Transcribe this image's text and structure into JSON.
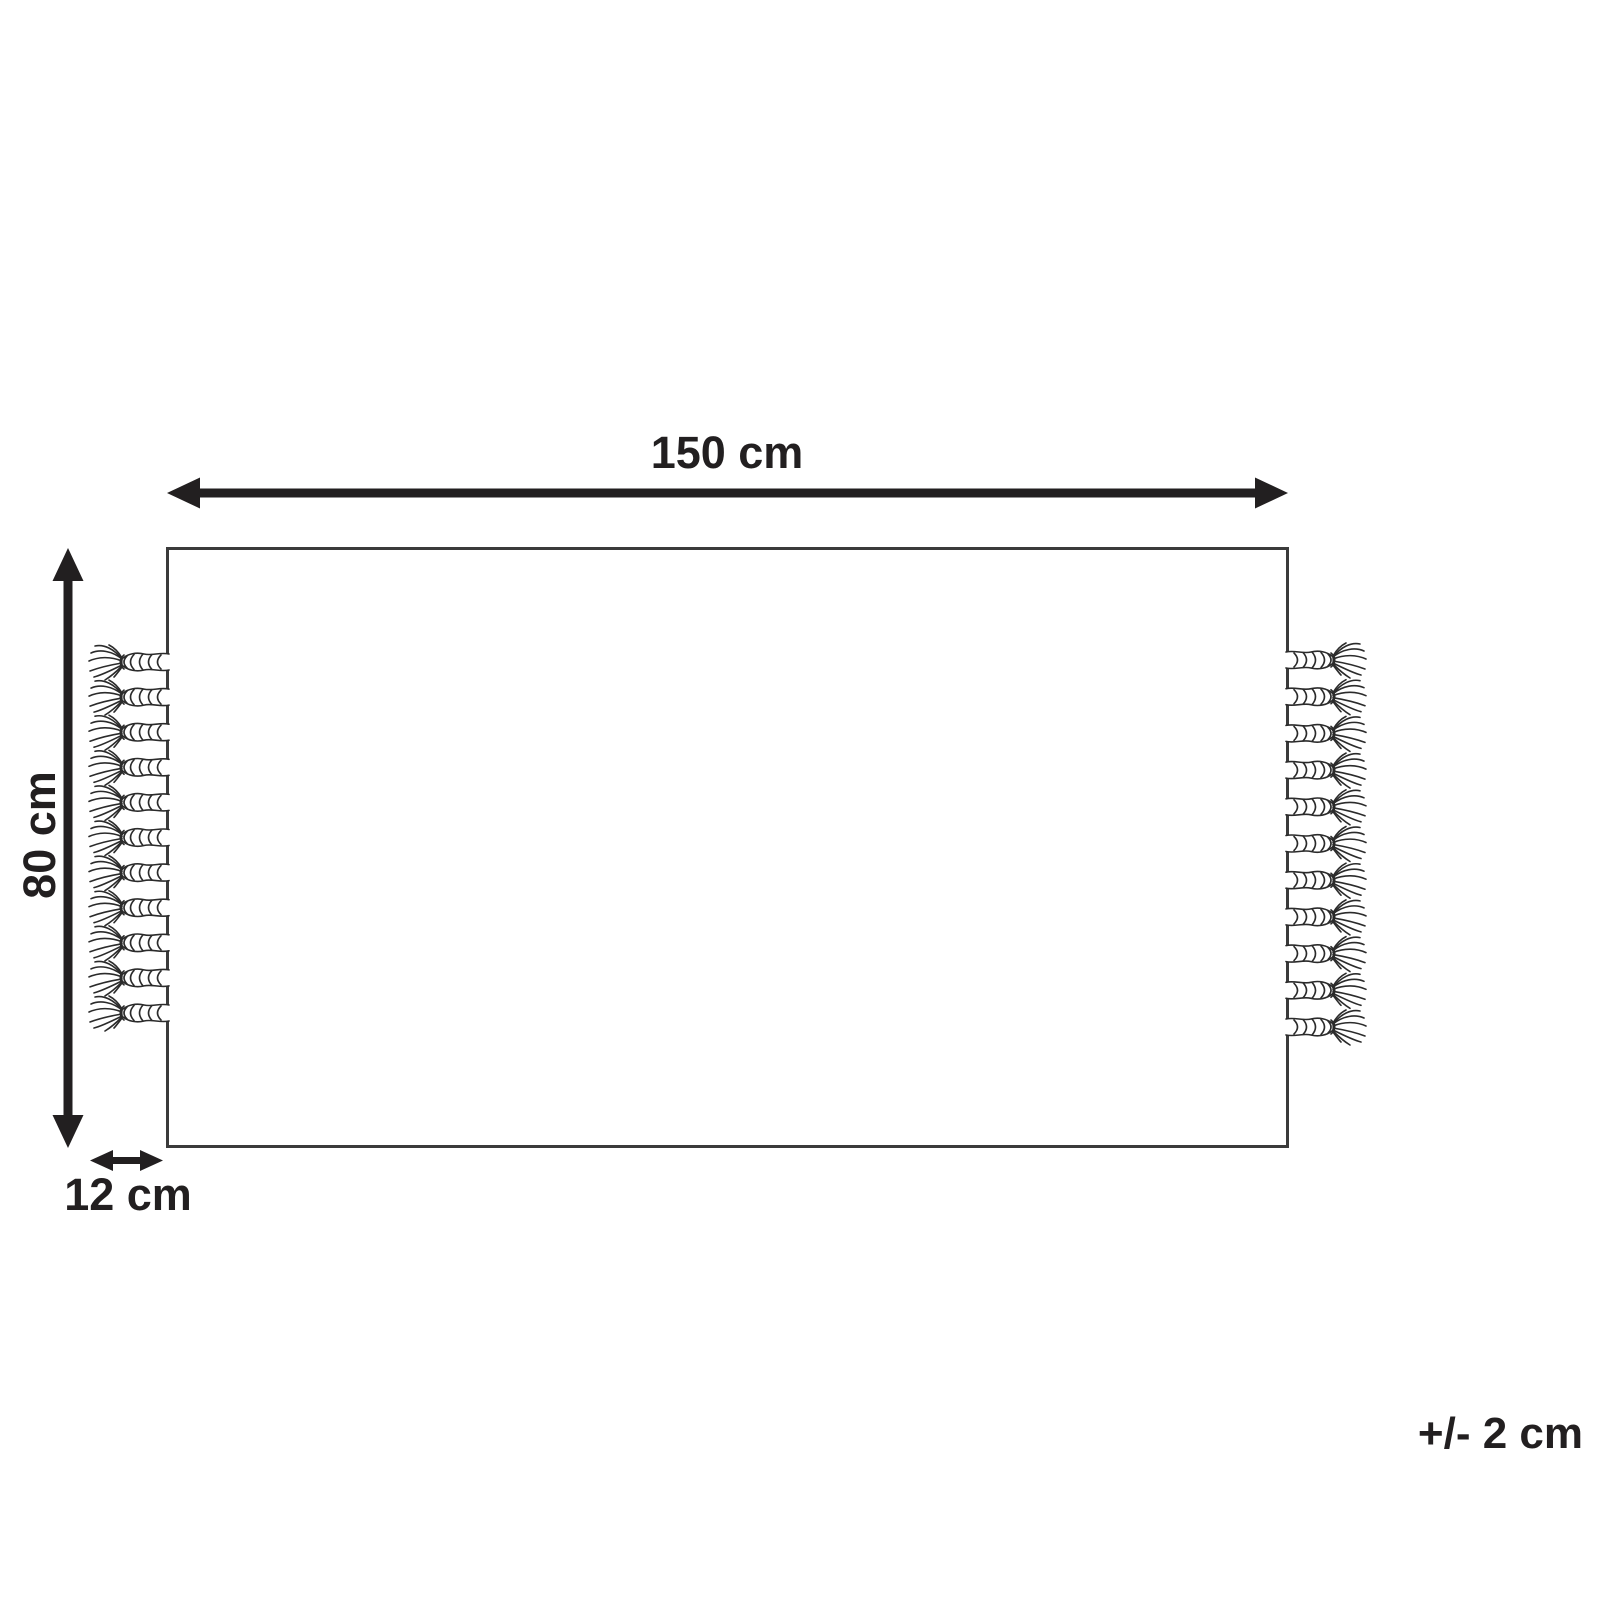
{
  "diagram": {
    "type": "product-dimension-diagram",
    "subject": "rug-with-fringe",
    "labels": {
      "width": "150 cm",
      "height": "80 cm",
      "fringe": "12 cm",
      "tolerance": "+/- 2 cm"
    },
    "dimensions": {
      "width_cm": 150,
      "height_cm": 80,
      "fringe_length_cm": 12,
      "tolerance_cm": 2
    },
    "fringe": {
      "tassels_per_side": 11,
      "sides": [
        "left",
        "right"
      ]
    },
    "colors": {
      "background": "#ffffff",
      "rug_outline": "#3b3b3b",
      "arrow": "#221f20",
      "text": "#221f20",
      "tassel_line": "#2b2b2b"
    }
  }
}
